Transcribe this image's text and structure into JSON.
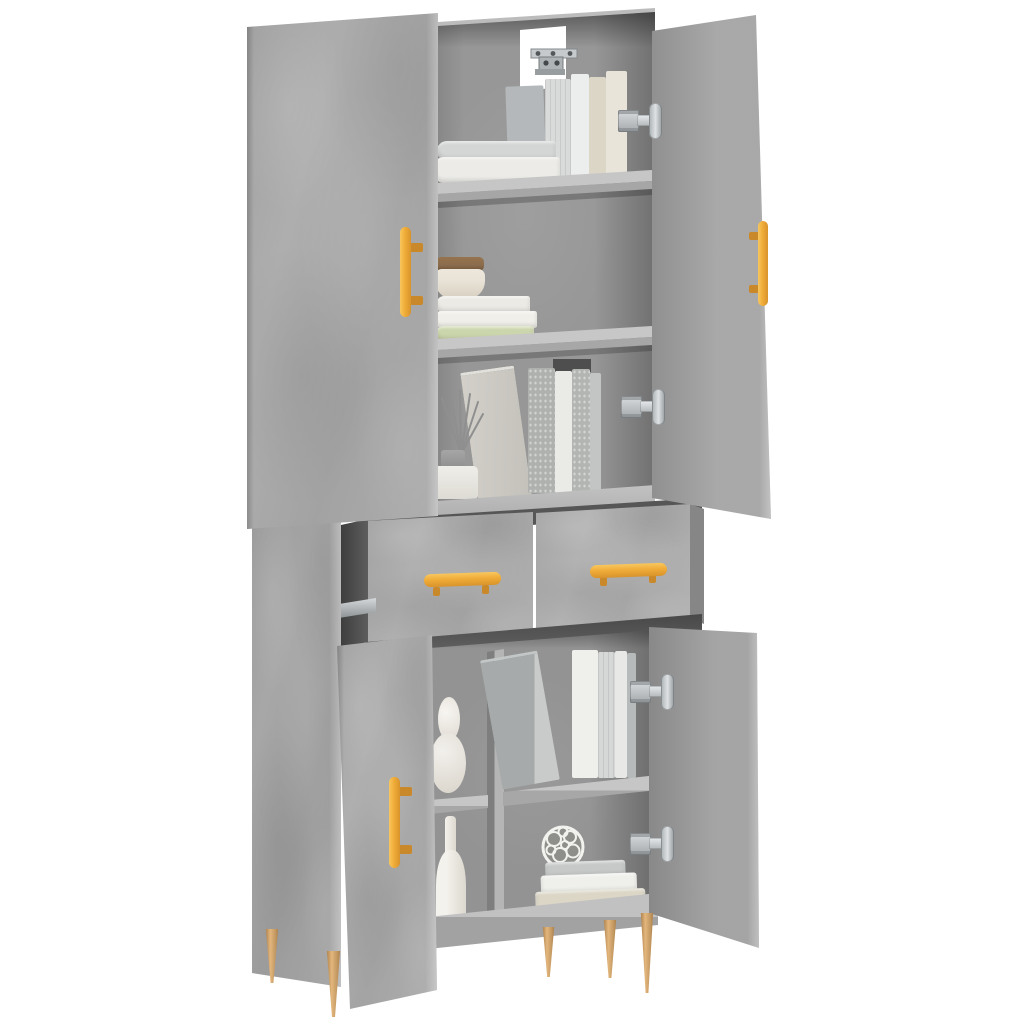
{
  "image_type": "product-photo",
  "subject": "Tall highboard cabinet in concrete grey with open doors, two ajar drawers, gold handles and tapered wooden legs, styled with books and decor",
  "palette": {
    "background": "#ffffff",
    "concrete_grey": "#a8a8a8",
    "concrete_dark": "#8f8f8f",
    "concrete_light": "#c6c6c6",
    "interior_shadow": "#565656",
    "gold_handle": "#f0ac38",
    "gold_handle_dark": "#c9892b",
    "leg_wood": "#c59a63",
    "leg_wood_light": "#e2b67c",
    "leg_wood_dark": "#a87b46",
    "hinge_silver": "#dfe2e4",
    "hinge_silver_dark": "#7c8184",
    "book_white": "#efefeb",
    "book_grey": "#b4b8ba",
    "book_beige": "#dbd6c6",
    "book_green": "#ccd6ac",
    "bowl_cream": "#e9e3d7",
    "bowl_wood_lid": "#8a6b4c",
    "vase_white": "#f2f0ec"
  },
  "scene": {
    "cabinet": {
      "material": "concrete grey engineered wood",
      "upper_doors": 2,
      "drawers": 2,
      "lower_doors": 2,
      "handles": "gold bar handles",
      "legs": "tapered brass-toned wooden legs",
      "hardware": [
        "soft-close hinges",
        "drawer slide rail",
        "wall anti-tip bracket"
      ]
    },
    "contents": {
      "top_compartment": [
        "two lying books",
        "five standing books in grey, white and beige"
      ],
      "middle_compartment": [
        "cream bowl with wooden lid on a stack of two white books and one green book"
      ],
      "third_compartment": [
        "reed diffuser in grey pot on white jar",
        "row of leaning grey and white books"
      ],
      "lower_left_compartment": [
        "white gourd-shaped vase",
        "white bottle vase"
      ],
      "lower_right_compartment": [
        "leaning grey book with standing white books",
        "openwork wire sphere ornament",
        "stack of three books in grey, white and beige"
      ]
    }
  }
}
